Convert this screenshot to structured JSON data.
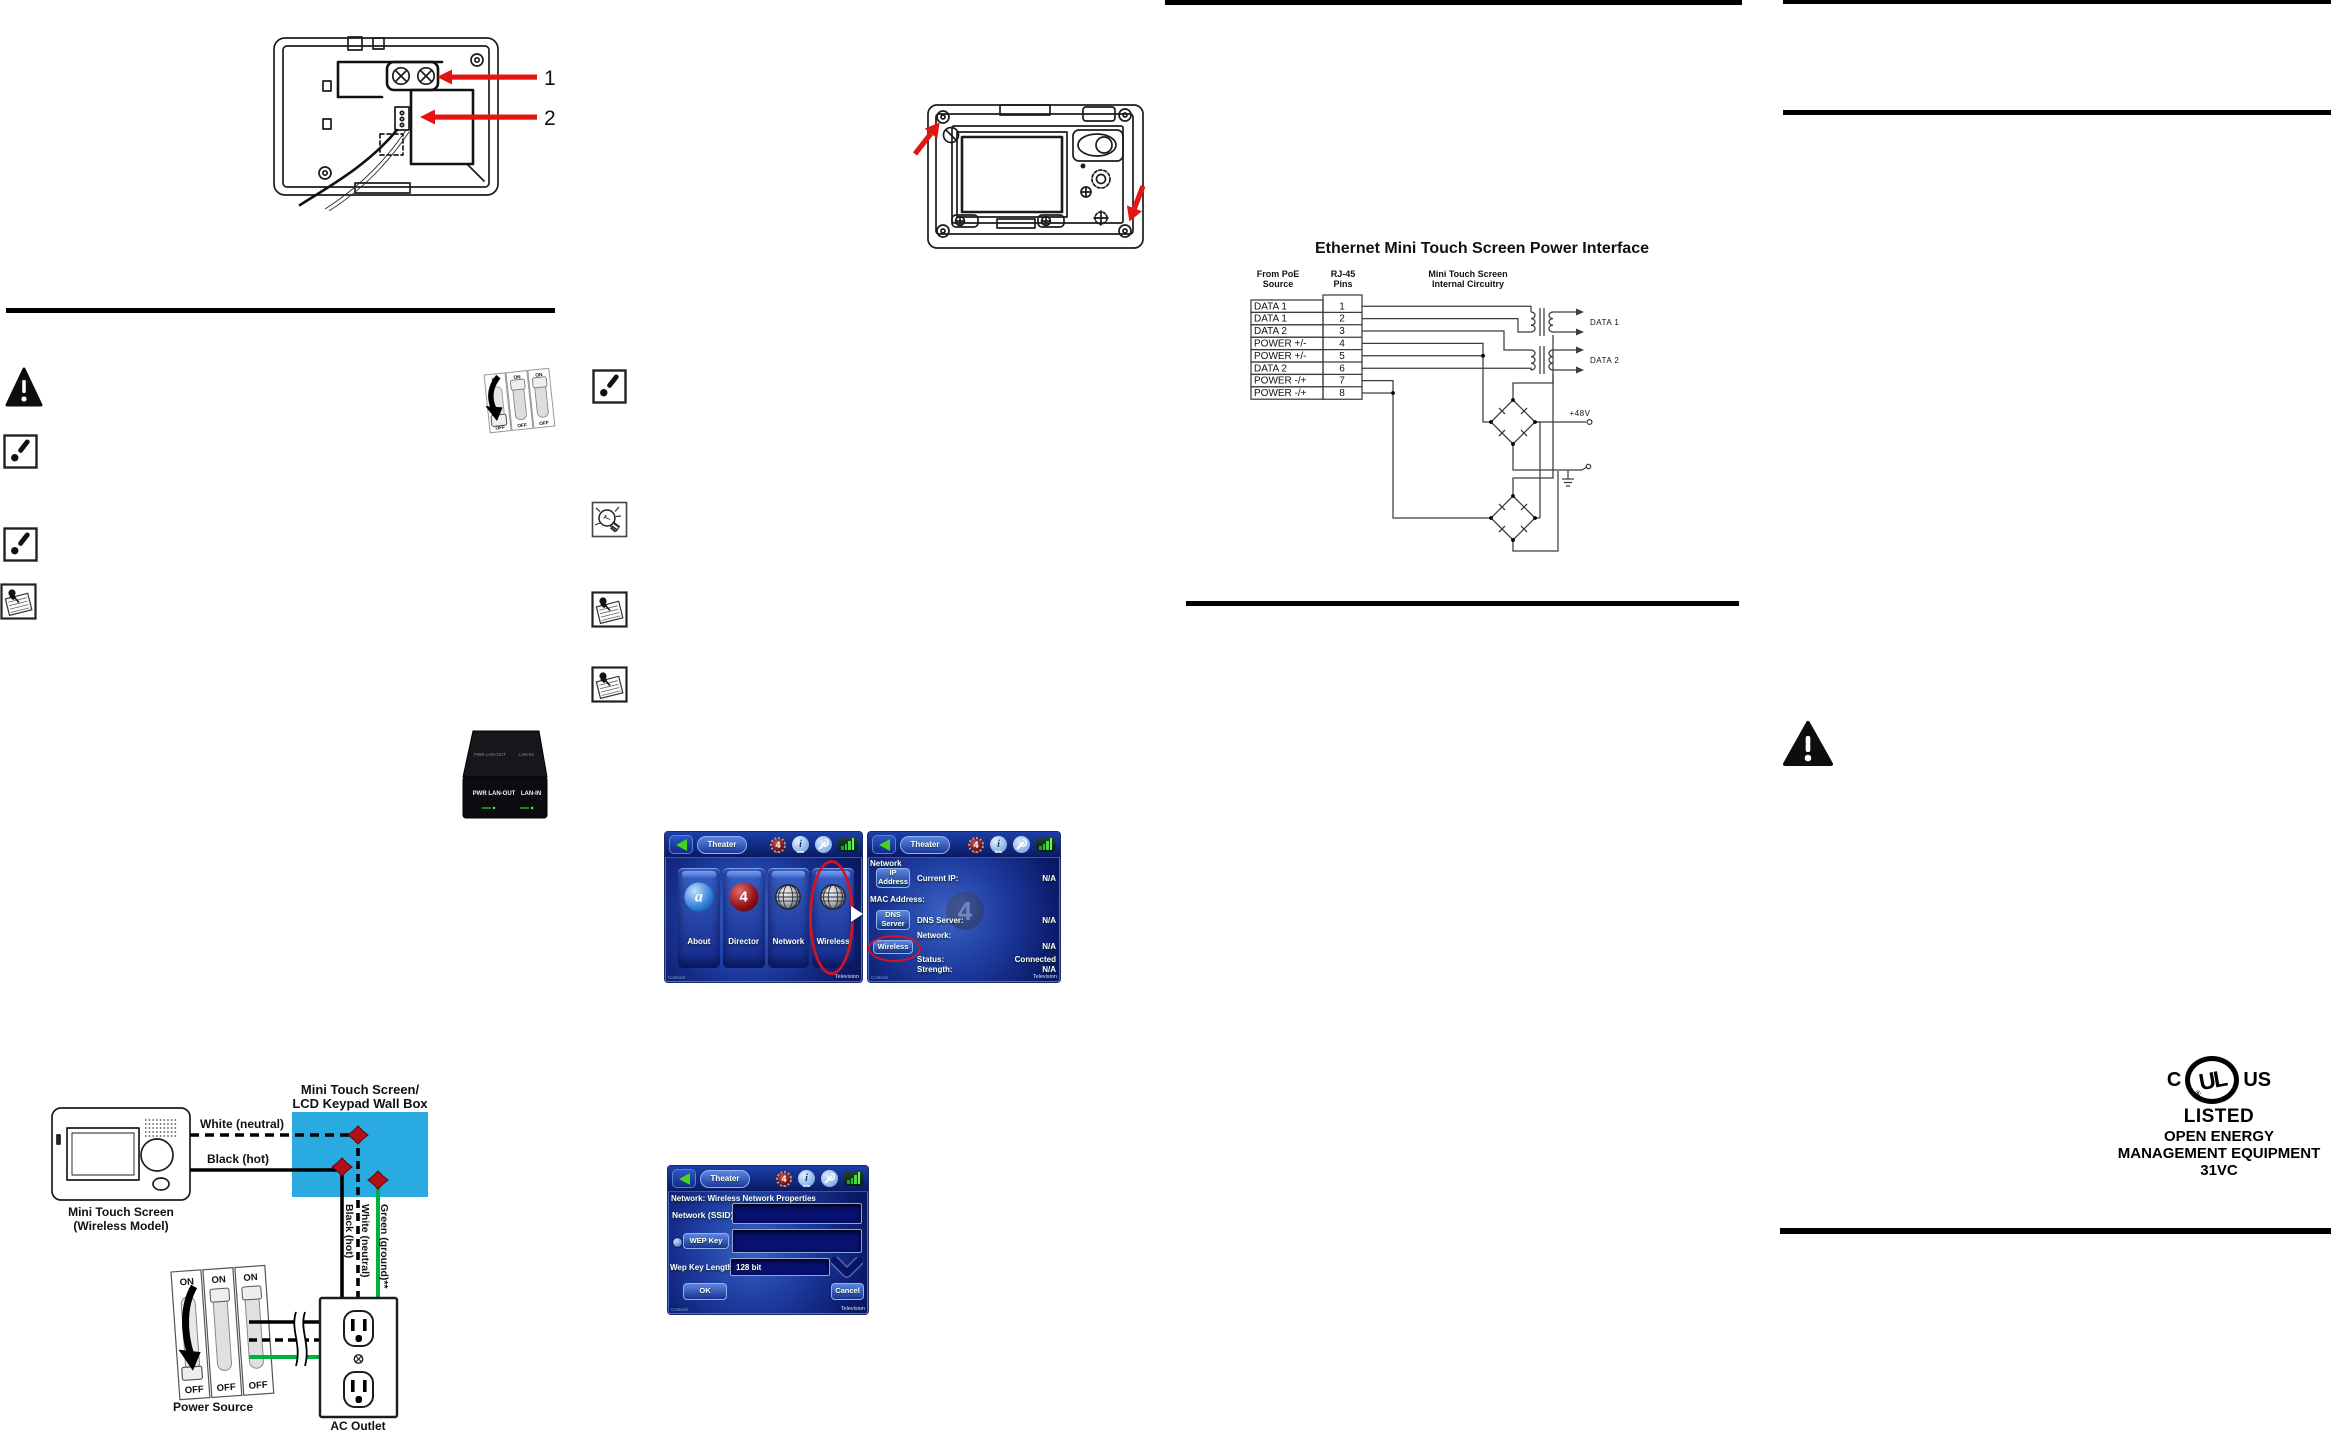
{
  "callouts": {
    "item1": "1",
    "item2": "2"
  },
  "ethernet": {
    "title": "Ethernet Mini Touch Screen Power Interface",
    "col_poe_line1": "From PoE",
    "col_poe_line2": "Source",
    "col_rj45_line1": "RJ-45",
    "col_rj45_line2": "Pins",
    "col_circuit_line1": "Mini Touch Screen",
    "col_circuit_line2": "Internal Circuitry",
    "rows": [
      {
        "label": "DATA 1",
        "pin": "1"
      },
      {
        "label": "DATA 1",
        "pin": "2"
      },
      {
        "label": "DATA 2",
        "pin": "3"
      },
      {
        "label": "POWER +/-",
        "pin": "4"
      },
      {
        "label": "POWER +/-",
        "pin": "5"
      },
      {
        "label": "DATA 2",
        "pin": "6"
      },
      {
        "label": "POWER -/+",
        "pin": "7"
      },
      {
        "label": "POWER -/+",
        "pin": "8"
      }
    ],
    "output1": "DATA 1",
    "output2": "DATA 2",
    "power_label": "+48V"
  },
  "screens": {
    "footer_brand": "Control4",
    "footer_right": "Television",
    "topbar": {
      "location": "Theater",
      "gear_glyph": "4",
      "info_glyph": "i",
      "info_label": "Info"
    },
    "main": {
      "tiles": [
        {
          "label": "About",
          "glyph": "a"
        },
        {
          "label": "Director",
          "glyph": "4"
        },
        {
          "label": "Network"
        },
        {
          "label": "Wireless"
        }
      ]
    },
    "network": {
      "heading": "Network",
      "buttons": [
        {
          "line1": "IP",
          "line2": "Address"
        },
        {
          "line1": "DNS",
          "line2": "Server"
        },
        {
          "line1": "Wireless"
        }
      ],
      "fields": {
        "current_ip_label": "Current IP:",
        "current_ip_value": "N/A",
        "mac_label": "MAC Address:",
        "dns_label": "DNS Server:",
        "dns_value": "N/A",
        "network_label": "Network:",
        "network_value": "N/A",
        "status_label": "Status:",
        "status_value": "Connected",
        "strength_label": "Strength:",
        "strength_value": "N/A"
      }
    },
    "wireless_props": {
      "heading": "Network: Wireless Network Properties",
      "ssid_label": "Network (SSID)",
      "wep_key_label": "WEP Key",
      "wep_length_label": "Wep Key Length",
      "wep_length_value": "128 bit",
      "ok_label": "OK",
      "cancel_label": "Cancel"
    }
  },
  "wiring": {
    "wallbox_title_line1": "Mini Touch Screen/",
    "wallbox_title_line2": "LCD Keypad Wall Box",
    "device_label_line1": "Mini Touch Screen",
    "device_label_line2": "(Wireless Model)",
    "neutral_label": "White (neutral)",
    "hot_label": "Black (hot)",
    "vertical_hot_label": "Black (hot)",
    "vertical_neutral_label": "White (neutral)",
    "vertical_ground_label": "Green (ground)**",
    "power_source_label": "Power Source",
    "ac_outlet_label": "AC Outlet",
    "switch_on": "ON",
    "switch_off": "OFF",
    "colors": {
      "wallbox": "#29abe2",
      "ground_wire": "#00b140",
      "wire_nut": "#b01117"
    }
  },
  "switch_sticker": {
    "on": "ON",
    "off": "OFF"
  },
  "poe_injector": {
    "label_pwr_lan_out": "PWR LAN-OUT",
    "label_lan_in": "LAN-IN"
  },
  "ul_mark": {
    "c": "C",
    "us": "US",
    "letters": "UL",
    "registered": "®",
    "listed": "LISTED",
    "line2": "OPEN ENERGY",
    "line3": "MANAGEMENT EQUIPMENT",
    "line4": "31VC"
  }
}
